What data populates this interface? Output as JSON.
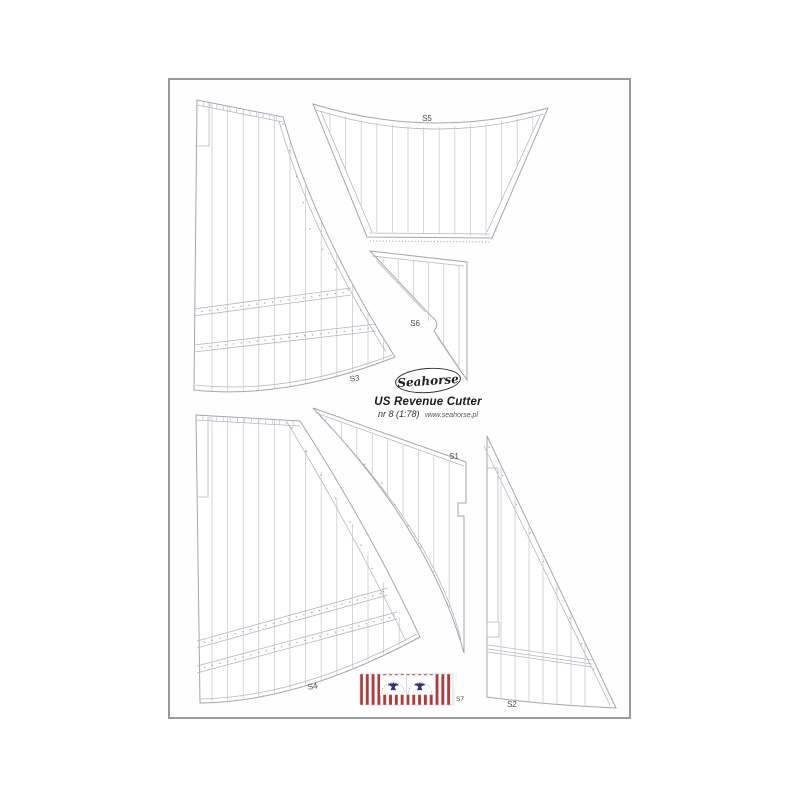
{
  "labels": {
    "s1": "S1",
    "s2": "S2",
    "s3": "S3",
    "s4": "S4",
    "s5": "S5",
    "s6": "S6",
    "s7": "S7"
  },
  "logo": {
    "brand": "Seahorse",
    "title": "US Revenue Cutter",
    "subtitle_nr": "nr 8 (1:78)",
    "subtitle_url": "www.seahorse.pl"
  },
  "colors": {
    "sheet_border": "#9a9a9a",
    "sail_edge": "#a2a6b0",
    "sail_line": "#b4b7c0",
    "sail_seam": "#c3c5cc",
    "sail_dot": "#9fa2ac",
    "flag_red": "#b23b3b",
    "flag_blue": "#34347f"
  }
}
